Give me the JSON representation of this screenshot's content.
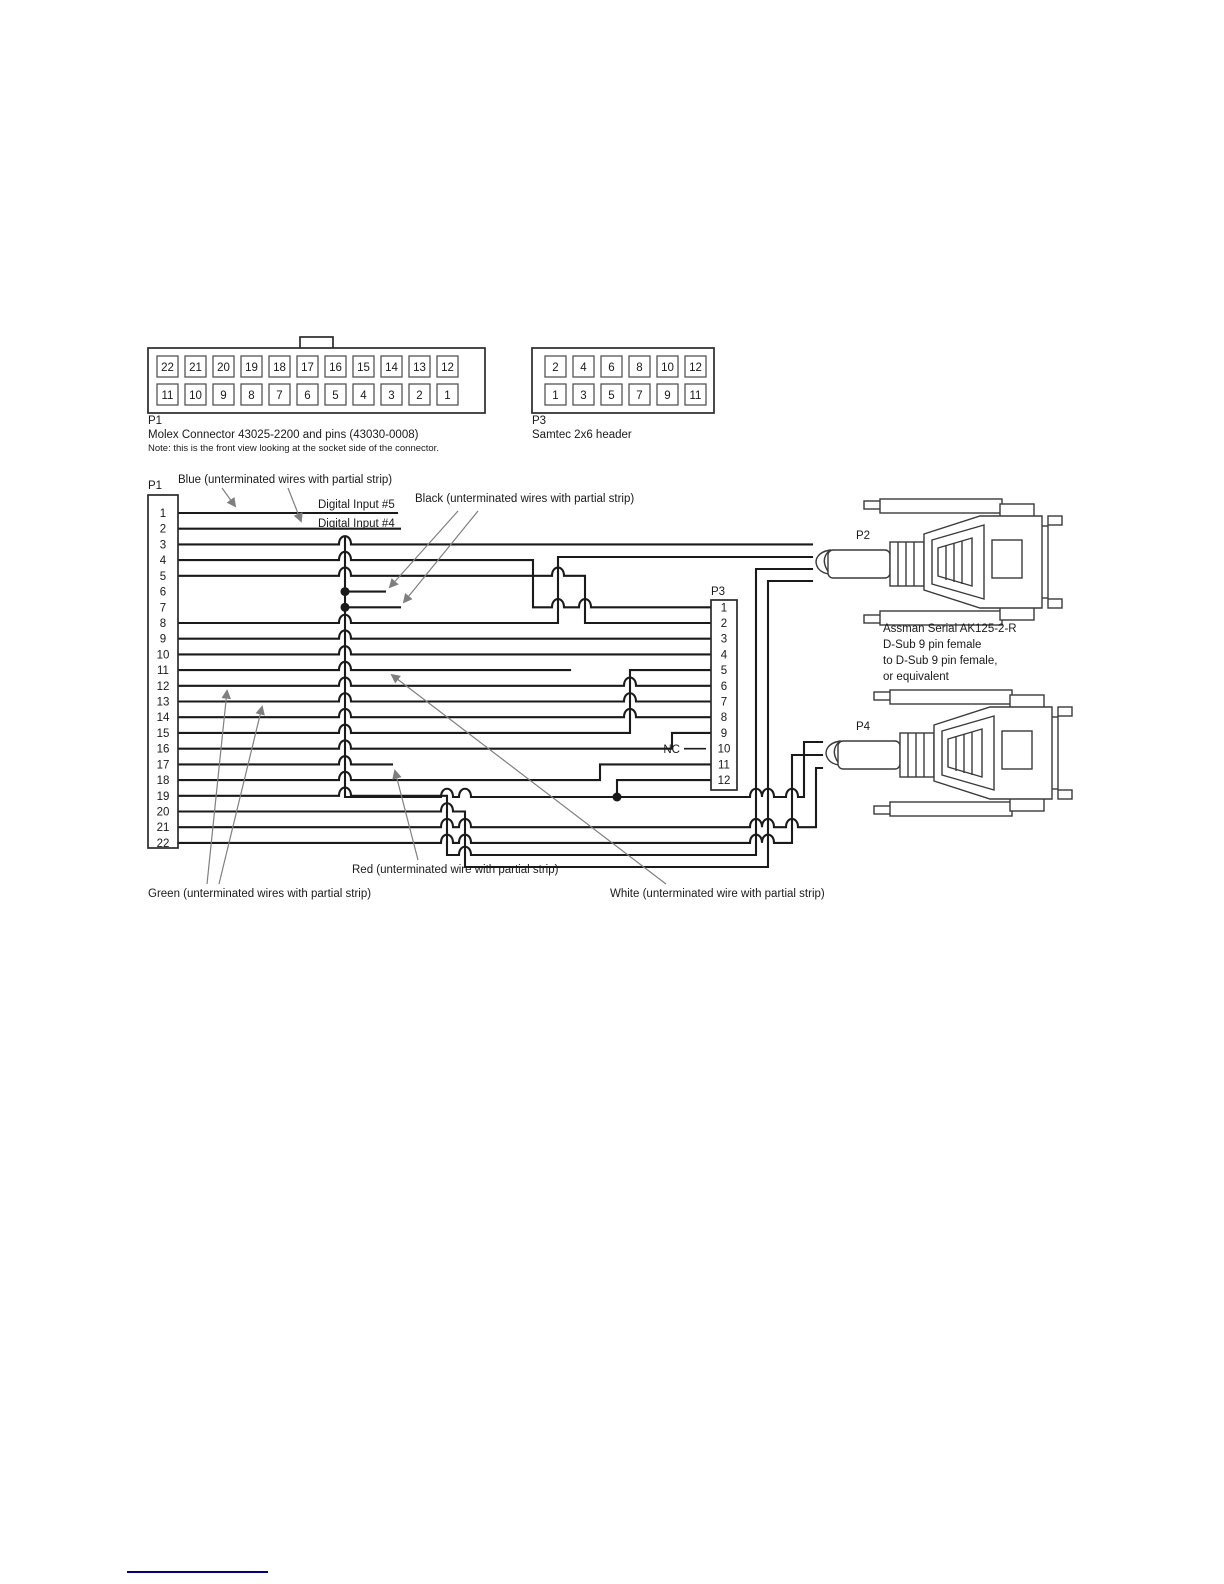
{
  "front_views": {
    "p1": {
      "name": "P1",
      "description": "Molex  Connector 43025-2200 and pins (43030-0008)",
      "note": "Note: this is the front view looking at the socket side of the connector.",
      "top_row": [
        "22",
        "21",
        "20",
        "19",
        "18",
        "17",
        "16",
        "15",
        "14",
        "13",
        "12"
      ],
      "bottom_row": [
        "11",
        "10",
        "9",
        "8",
        "7",
        "6",
        "5",
        "4",
        "3",
        "2",
        "1"
      ]
    },
    "p3": {
      "name": "P3",
      "description": "Samtec 2x6 header",
      "top_row": [
        "2",
        "4",
        "6",
        "8",
        "10",
        "12"
      ],
      "bottom_row": [
        "1",
        "3",
        "5",
        "7",
        "9",
        "11"
      ]
    }
  },
  "wiring": {
    "p1": {
      "name": "P1",
      "pins": [
        "1",
        "2",
        "3",
        "4",
        "5",
        "6",
        "7",
        "8",
        "9",
        "10",
        "11",
        "12",
        "13",
        "14",
        "15",
        "16",
        "17",
        "18",
        "19",
        "20",
        "21",
        "22"
      ]
    },
    "p3": {
      "name": "P3",
      "pins": [
        "1",
        "2",
        "3",
        "4",
        "5",
        "6",
        "7",
        "8",
        "9",
        "10",
        "11",
        "12"
      ],
      "nc": "NC"
    },
    "p2": {
      "name": "P2"
    },
    "p4": {
      "name": "P4"
    },
    "p2_p4_note": [
      "Assman Serial AK125-2-R",
      "D-Sub 9 pin female",
      "to D-Sub 9 pin female,",
      "or equivalent"
    ],
    "labels": {
      "blue": "Blue (unterminated wires with partial strip)",
      "digital_input_5": "Digital Input #5",
      "digital_input_4": "Digital Input #4",
      "black": "Black (unterminated wires with partial strip)",
      "red": "Red (unterminated wire with partial strip)",
      "green": "Green (unterminated wires with partial strip)",
      "white": "White (unterminated wire with partial strip)"
    }
  },
  "colors": {
    "wire": "#1a1a1a",
    "annotation_gray": "#7f7f7f",
    "footer_rule": "#000080",
    "background": "#ffffff"
  }
}
